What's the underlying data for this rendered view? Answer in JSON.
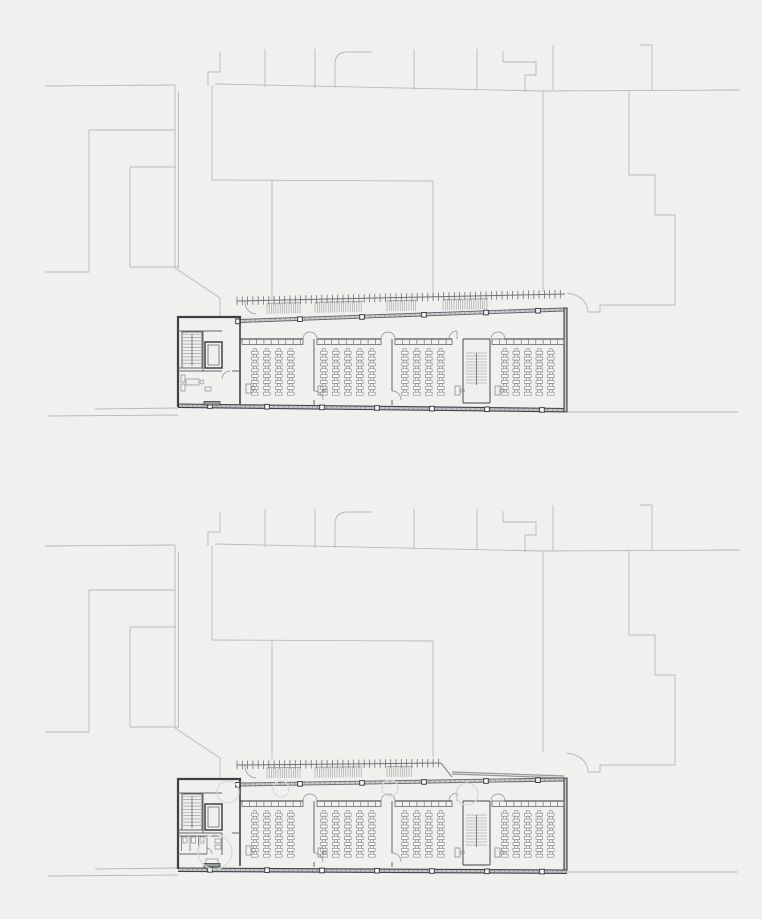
{
  "scene": {
    "width": 762,
    "height": 919,
    "background": "#f0f0ee",
    "description": "site plan with two stacked floor plans of a long classroom building"
  },
  "palette": {
    "context": "#b7babc",
    "wall": "#3e4144",
    "partition": "#63666a",
    "furniture": "#8b8e91",
    "glassFill": "#cbcdce",
    "bandFill": "#c3c5c7",
    "canopy": "#6e7174",
    "hatch": "#95989b",
    "tree": "#d7d9d7",
    "white": "#ffffff"
  },
  "context_paths": [
    "M45,86 L175,85",
    "M175,85 L175,268 M178.5,92 L178.5,268",
    "M130,267 L178,267 M130,267 L130,167 L176,167",
    "M45,272 L89,272 L89,130 L175,130",
    "M208,86 L208,72 L220,72 L220,52",
    "M215,84 L543,91 L740,90",
    "M212,86 L212,180 L433,181 M272,180 L272,299 M433,181 L433,297",
    "M543,91 L543,292",
    "M265,49 L265,87 M315,49 L315,88 M414,49 L414,90 M477,49 L477,90 M553,45 L553,90",
    "M335,88 L335,64 Q335,52 348,52 L372,52",
    "M503,51 L503,62 L536,62 L536,75 L525,75 L525,92",
    "M640,45 L652,45 L652,90",
    "M629,90 L629,175 L655,175 L655,215 L675,215 L675,305 L600,305 L600,312 L588,312 Q587,296 567,293",
    "M175,268 L220,298 L220,317",
    "M48,416 L178,415 M95,409 L178,408 M567,412 L738,412"
  ],
  "building": {
    "wallPaths": [
      {
        "d": "M240,2.5 L240,0 L178,0 L178,90",
        "w": 2.2,
        "c": "wall"
      },
      {
        "d": "M240,2.5 L240,87",
        "w": 1.6,
        "c": "wall"
      },
      {
        "d": "M178,14 L222,14 M203,14 L203,54 M178,51 L203,51 M178,54 L222,54 M232,54 L240,54",
        "w": 1.0,
        "c": "partition"
      },
      {
        "d": "M314,22 L314,74 M314,83 L314,88 M392,22 L392,74 M392,83 L392,88",
        "w": 1.0,
        "c": "partition"
      },
      {
        "d": "M463,22 L463,86 M490,22 L490,86 M463,22 L490,22 M463,86 L490,86",
        "w": 1.2,
        "c": "partition"
      },
      {
        "d": "M205,25 L222,25 L222,51 L205,51 Z",
        "w": 1.5,
        "c": "wall"
      },
      {
        "d": "M208,28 L219,28 L219,48 L208,48 Z",
        "w": 0.8,
        "c": "partition"
      },
      {
        "d": "M182,15 L202,15 L202,51 L182,51 Z",
        "w": 1.0,
        "c": "partition"
      }
    ],
    "frontWall": {
      "y": 22,
      "w": 1.3,
      "segs": [
        [
          240,
          303
        ],
        [
          317,
          381
        ],
        [
          395,
          452
        ],
        [
          504,
          564
        ]
      ]
    },
    "doorArcs": [
      {
        "type": "double",
        "cx": 310,
        "r": 7
      },
      {
        "type": "double",
        "cx": 388,
        "r": 7
      },
      {
        "type": "single",
        "cx": 457,
        "r": 8
      },
      {
        "type": "double",
        "cx": 498,
        "r": 7
      }
    ],
    "sideDoorArcPaths": "M314,74 A9,9 0 0 1 323,83 M392,74 A9,9 0 0 1 401,83",
    "cabinets": {
      "y": 22,
      "h": 5.5,
      "seg": 7.3,
      "ranges": [
        [
          242,
          303
        ],
        [
          317,
          381
        ],
        [
          395,
          452
        ],
        [
          492,
          564
        ]
      ]
    },
    "stair1Treads": {
      "x1": 183,
      "x2": 201,
      "yStart": 17.5,
      "yEnd": 49,
      "step": 3.2,
      "railX": 192
    },
    "stair2Treads": {
      "x1": 466,
      "x2": 487,
      "yStart": 36,
      "yEnd": 68,
      "step": 3,
      "railX": 476.5
    },
    "desks": {
      "unit": {
        "w": 6.6,
        "h": 2.9,
        "r": 1.7
      },
      "pitch": 5.85,
      "count": 8,
      "yStart": 33,
      "rooms": [
        [
          251.5,
          263.5,
          275.5,
          287.5
        ],
        [
          320.5,
          332.5,
          344.5,
          356.5,
          368.5
        ],
        [
          401.5,
          413.5,
          425.5,
          437.5
        ],
        [
          501.5,
          513,
          524.5,
          536,
          547.5
        ]
      ]
    },
    "roomNames": [
      "classroom-1",
      "classroom-2",
      "classroom-3",
      "classroom-4"
    ],
    "teacherDesks": [
      [
        246,
        67
      ],
      [
        318,
        69
      ],
      [
        455,
        69
      ],
      [
        495,
        69
      ]
    ],
    "facadeTop": {
      "x1": 240,
      "x2": 564,
      "h": 3.0,
      "tickStep": 5,
      "posts": [
        238,
        300,
        362,
        424,
        486,
        538
      ],
      "postSize": 4.6
    },
    "facadeBottom": {
      "x1": 178,
      "x2": 567,
      "h": 3.4,
      "tickStep": 4.8,
      "posts": [
        210,
        267,
        322,
        377,
        432,
        487,
        542
      ],
      "postSize": 4.6
    },
    "entryMat": [
      204,
      84.5,
      16,
      3.5
    ],
    "leftRoomFurniture": {
      "rects": [
        [
          181,
          58,
          4,
          7
        ],
        [
          181,
          67,
          4,
          7
        ],
        [
          186,
          62,
          13,
          6
        ],
        [
          205,
          70,
          6,
          4
        ]
      ],
      "circles": [
        [
          202,
          65,
          2
        ]
      ],
      "arcs": "M230,54 A8,8 0 0 0 222,62"
    },
    "toilets": {
      "walls": "M178,57 L222,57 M222,54 L222,76 M178,75 L207,75",
      "dividers": "M181.5,57 L181.5,72 M190,57 L190,72 M198.5,57 L198.5,72 M207,57 L207,75",
      "fixtures": [
        [
          183,
          58,
          4,
          6
        ],
        [
          191.5,
          58,
          4,
          6
        ],
        [
          200,
          58,
          4,
          6
        ],
        [
          215,
          60,
          6,
          4
        ],
        [
          215,
          66,
          6,
          4
        ],
        [
          206,
          80,
          12,
          5
        ]
      ],
      "arcs": "M212,75 A6,6 0 0 0 206,69"
    }
  },
  "plans": [
    {
      "name": "upper-floor-plan",
      "baseY": 317,
      "contextOffsetY": 0,
      "facadeTop": {
        "y1": 2.5,
        "y2": -9
      },
      "rightWall": {
        "top": -9,
        "bottom": 95
      },
      "band": {
        "y1": 87,
        "y2": 91.5
      },
      "canopy": {
        "x1": 237,
        "x2": 565,
        "y1": -16,
        "y2": -23,
        "tickStep": 5.3,
        "tickLen": 8.5,
        "hatches": [
          [
            267,
            300
          ],
          [
            315,
            363
          ],
          [
            387,
            417
          ],
          [
            443,
            488
          ]
        ],
        "leftArc": true
      },
      "leftBlock": "room",
      "trees": []
    },
    {
      "name": "ground-floor-plan",
      "baseY": 779,
      "contextOffsetY": 460,
      "facadeTop": {
        "y1": 4,
        "y2": -1
      },
      "rightWall": {
        "top": -1,
        "bottom": 91
      },
      "band": {
        "y1": 89,
        "y2": 91
      },
      "canopy": {
        "x1": 237,
        "x2": 441,
        "y1": -14,
        "y2": -16,
        "tickStep": 5.3,
        "tickLen": 8.5,
        "slant": [
          452,
          -2
        ],
        "eastBand": [
          [
            452,
            -7
          ],
          [
            564,
            -3
          ]
        ],
        "hatches": [
          [
            267,
            300
          ],
          [
            315,
            362
          ],
          [
            387,
            413
          ]
        ],
        "leftArc": true
      },
      "leftBlock": "toilets",
      "trees": [
        [
          215,
          73,
          17
        ],
        [
          228,
          13,
          11
        ],
        [
          281,
          10,
          8
        ],
        [
          390,
          9,
          8
        ],
        [
          467,
          15,
          11
        ]
      ]
    }
  ]
}
